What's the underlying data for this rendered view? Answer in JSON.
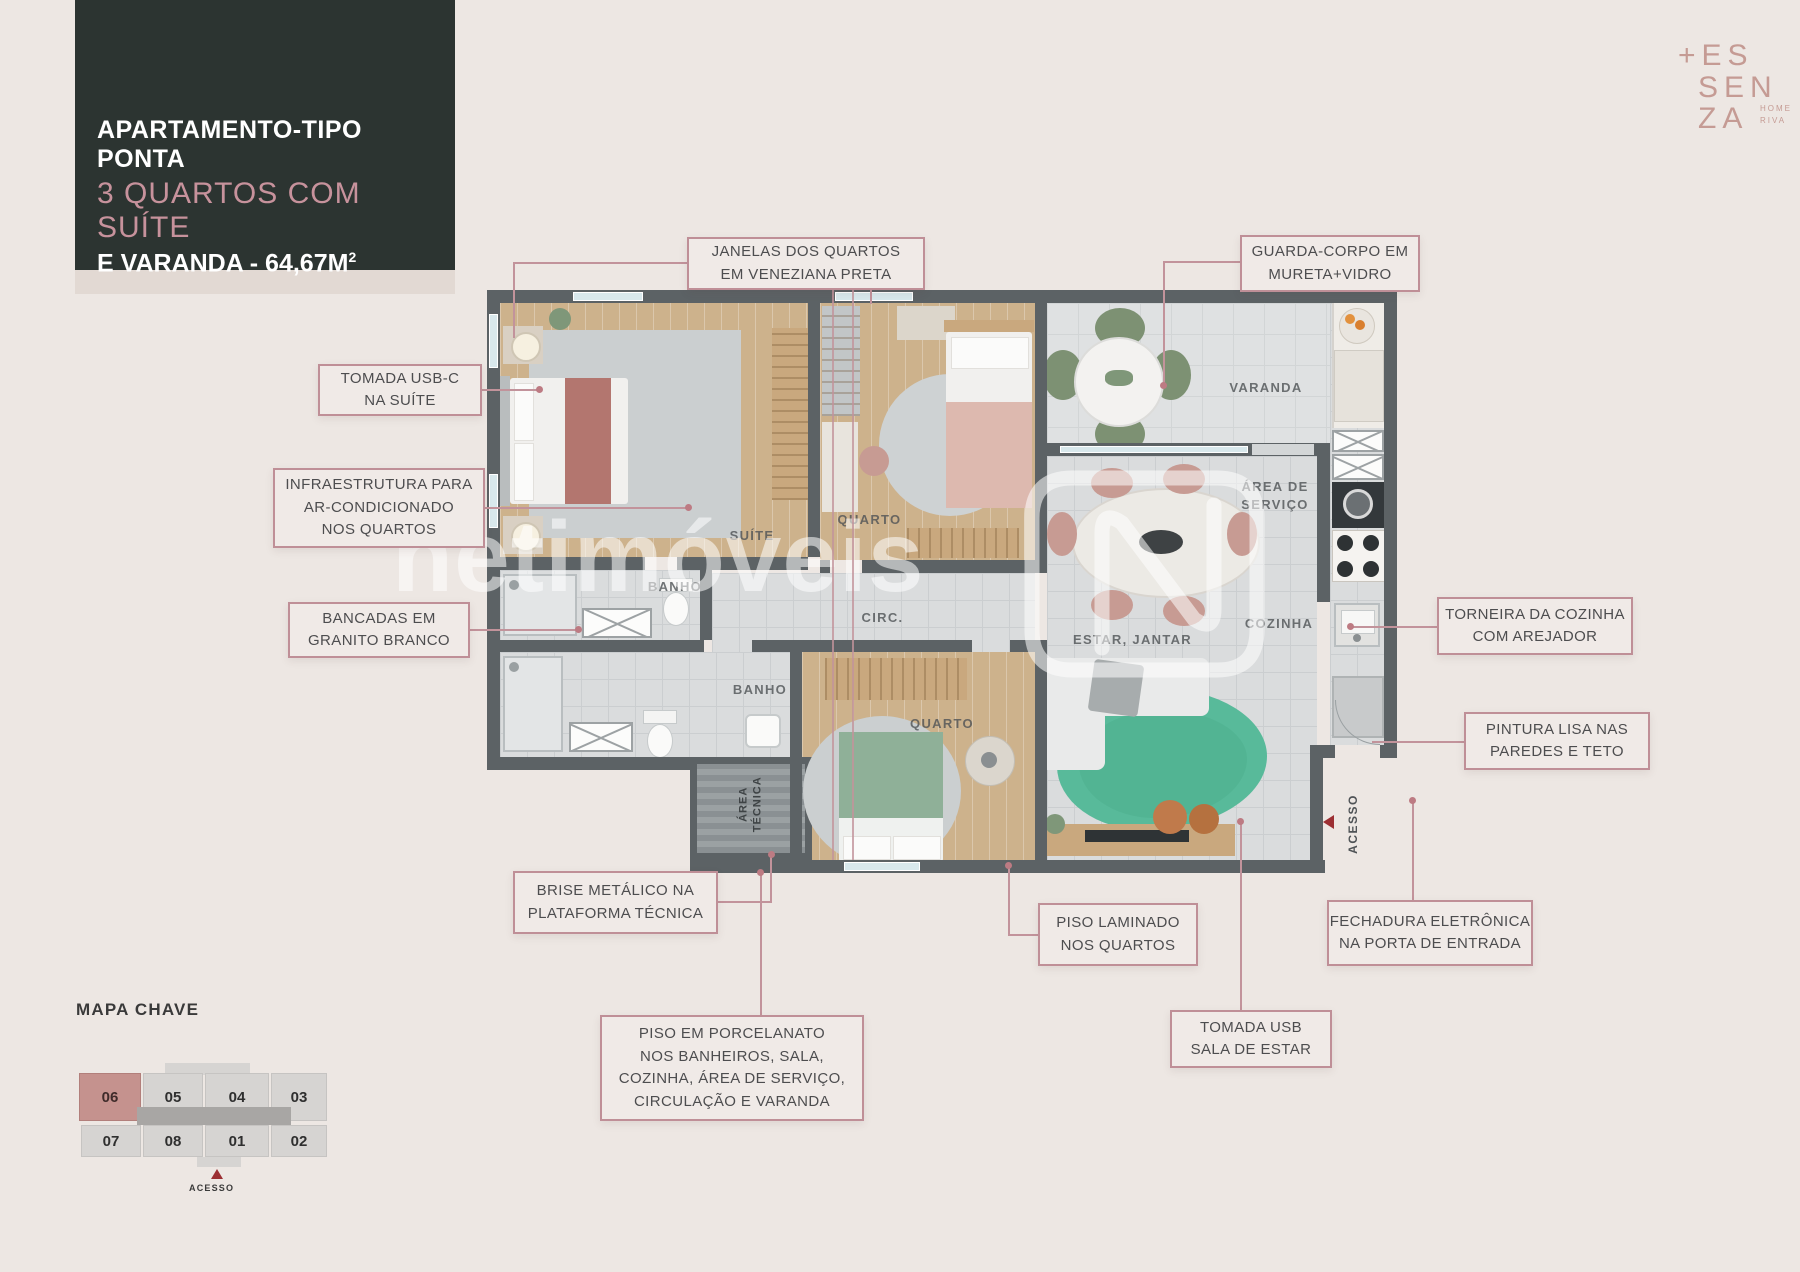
{
  "header": {
    "title_line1": "APARTAMENTO-TIPO PONTA",
    "title_line2": "3 QUARTOS COM SUÍTE",
    "title_line3": "E VARANDA - 64,67M",
    "title_sup": "2"
  },
  "logo": {
    "plus": "+",
    "line1": "ES",
    "line2": "SEN",
    "line3": "ZA",
    "tag1": "HOME",
    "tag2": "RIVA"
  },
  "watermark": "netimóveis",
  "callouts": [
    {
      "id": "janelas",
      "lines": [
        "JANELAS DOS QUARTOS",
        "EM VENEZIANA PRETA"
      ]
    },
    {
      "id": "guarda_corpo",
      "lines": [
        "GUARDA-CORPO EM",
        "MURETA+VIDRO"
      ]
    },
    {
      "id": "tomada_usbc",
      "lines": [
        "TOMADA USB-C",
        "NA SUÍTE"
      ]
    },
    {
      "id": "infraestrutura",
      "lines": [
        "INFRAESTRUTURA PARA",
        "AR-CONDICIONADO",
        "NOS QUARTOS"
      ]
    },
    {
      "id": "bancadas",
      "lines": [
        "BANCADAS EM",
        "GRANITO BRANCO"
      ]
    },
    {
      "id": "torneira",
      "lines": [
        "TORNEIRA DA COZINHA",
        "COM AREJADOR"
      ]
    },
    {
      "id": "pintura",
      "lines": [
        "PINTURA LISA NAS",
        "PAREDES E TETO"
      ]
    },
    {
      "id": "brise",
      "lines": [
        "BRISE METÁLICO NA",
        "PLATAFORMA TÉCNICA"
      ]
    },
    {
      "id": "piso_laminado",
      "lines": [
        "PISO LAMINADO",
        "NOS QUARTOS"
      ]
    },
    {
      "id": "fechadura",
      "lines": [
        "FECHADURA ELETRÔNICA",
        "NA PORTA DE ENTRADA"
      ]
    },
    {
      "id": "porcelanato",
      "lines": [
        "PISO EM PORCELANATO",
        "NOS BANHEIROS, SALA,",
        "COZINHA, ÁREA DE SERVIÇO,",
        "CIRCULAÇÃO E VARANDA"
      ]
    },
    {
      "id": "tomada_usb",
      "lines": [
        "TOMADA USB",
        "SALA DE ESTAR"
      ]
    }
  ],
  "plan_labels": {
    "suite": "SUÍTE",
    "quarto1": "QUARTO",
    "banho1": "BANHO",
    "circ": "CIRC.",
    "banho2": "BANHO",
    "quarto2": "QUARTO",
    "estar": "ESTAR, JANTAR",
    "cozinha": "COZINHA",
    "varanda": "VARANDA",
    "servico_l1": "ÁREA DE",
    "servico_l2": "SERVIÇO",
    "area_tecnica_l1": "ÁREA",
    "area_tecnica_l2": "TÉCNICA",
    "acesso": "ACESSO"
  },
  "mapa_chave": {
    "heading": "MAPA CHAVE",
    "top_row": [
      "06",
      "05",
      "04",
      "03"
    ],
    "bottom_row": [
      "07",
      "08",
      "01",
      "02"
    ],
    "highlighted_unit": "06",
    "acesso": "ACESSO"
  },
  "colors": {
    "background": "#EDE7E3",
    "title_box": "#2C3431",
    "accent_rose": "#C7929C",
    "callout_border": "#BF8F97",
    "wall": "#5C6265",
    "highlight_unit": "#C5928E",
    "acesso_red": "#9C2F33"
  }
}
